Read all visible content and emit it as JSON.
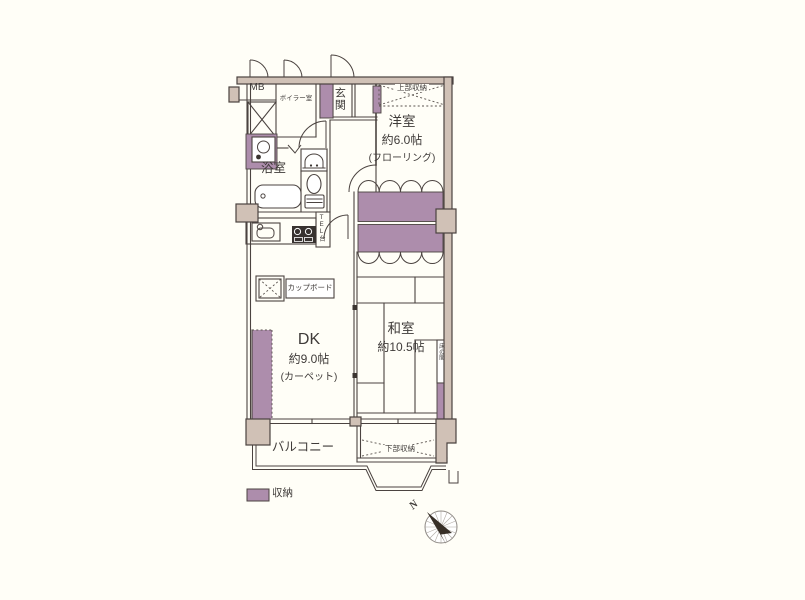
{
  "fp": {
    "labels": {
      "mb": "MB",
      "boiler_room": "ボイラー室",
      "entrance": "玄関",
      "upper_storage": "上部収納",
      "western_room_name": "洋室",
      "western_room_size": "約6.0帖",
      "western_room_floor": "(フローリング)",
      "bathroom": "浴室",
      "tel_stand": "TEL台",
      "cupboard": "カップボード",
      "dk_name": "DK",
      "dk_size": "約9.0帖",
      "dk_floor": "(カーペット)",
      "japanese_room_name": "和室",
      "japanese_room_size": "約10.5帖",
      "tokonoma": "床の間",
      "balcony": "バルコニー",
      "lower_storage": "下部収納"
    },
    "legend": {
      "label": "収納"
    },
    "compass": {
      "north": "N"
    },
    "colors": {
      "storage_fill": "#ad8dac",
      "wall_fill": "#d0c1b6",
      "line": "#4b4340",
      "background": "#fffef7",
      "text": "#3f3b39"
    }
  }
}
